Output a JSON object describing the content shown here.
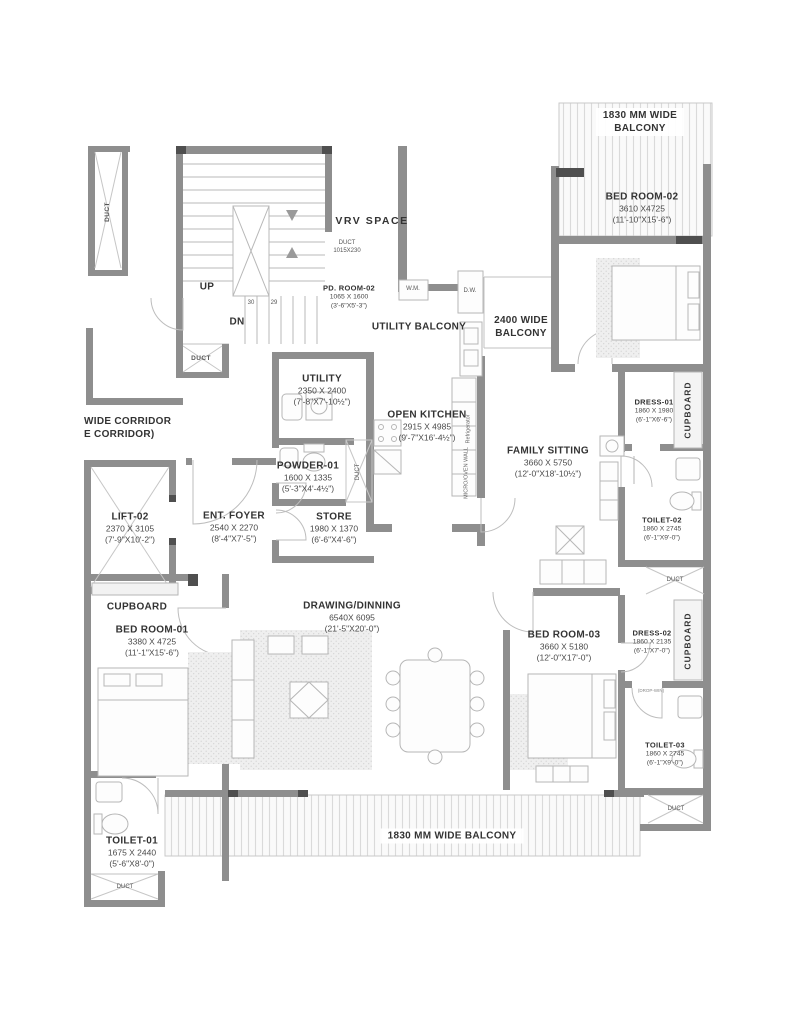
{
  "palette": {
    "wall": "#8e8e8e",
    "jamb": "#4f4f4f",
    "thin": "#c2c2c2",
    "furn": "#b6b6b6",
    "hatch": "#d8d8d8",
    "text": "#3a3a3a"
  },
  "areas": {
    "balcony_top": {
      "line1": "1830 MM  WIDE",
      "line2": "BALCONY"
    },
    "balcony_bottom": {
      "line1": "1830 MM WIDE BALCONY"
    },
    "balcony_2400": {
      "line1": "2400 WIDE",
      "line2": "BALCONY"
    },
    "utility_balcony": {
      "line1": "UTILITY BALCONY"
    },
    "vrv": {
      "line1": "VRV  SPACE"
    },
    "corridor": {
      "line1": "WIDE CORRIDOR",
      "line2": "E CORRIDOR)"
    }
  },
  "rooms": {
    "bedroom02": {
      "name": "BED ROOM-02",
      "mm": "3610 X4725",
      "ft": "(11'-10\"X15'-6\")"
    },
    "dress01": {
      "name": "DRESS-01",
      "mm": "1860 X 1980",
      "ft": "(6'-1\"X6'-6\")"
    },
    "toilet02": {
      "name": "TOILET-02",
      "mm": "1860 X 2745",
      "ft": "(6'-1\"X9'-0\")"
    },
    "dress02": {
      "name": "DRESS-02",
      "mm": "1860 X 2135",
      "ft": "(6'-1\"X7'-0\")"
    },
    "toilet03": {
      "name": "TOILET-03",
      "mm": "1860 X 2745",
      "ft": "(6'-1\"X9'-0\")"
    },
    "bedroom03": {
      "name": "BED ROOM-03",
      "mm": "3660 X 5180",
      "ft": "(12'-0\"X17'-0\")"
    },
    "family_sitting": {
      "name": "FAMILY SITTING",
      "mm": "3660 X 5750",
      "ft": "(12'-0\"X18'-10½\")"
    },
    "open_kitchen": {
      "name": "OPEN KITCHEN",
      "mm": "2915 X 4985",
      "ft": "(9'-7\"X16'-4½\")"
    },
    "utility": {
      "name": "UTILITY",
      "mm": "2350 X 2400",
      "ft": "(7'-8\"X7'-10½\")"
    },
    "powder01": {
      "name": "POWDER-01",
      "mm": "1600 X 1335",
      "ft": "(5'-3\"X4'-4½\")"
    },
    "store": {
      "name": "STORE",
      "mm": "1980 X 1370",
      "ft": "(6'-6\"X4'-6\")"
    },
    "pd_room02": {
      "name": "PD. ROOM-02",
      "mm": "1065 X 1600",
      "ft": "(3'-6\"X5'-3\")"
    },
    "lift02": {
      "name": "LIFT-02",
      "mm": "2370  X 3105",
      "ft": "(7'-9\"X10'-2\")"
    },
    "ent_foyer": {
      "name": "ENT. FOYER",
      "mm": "2540 X 2270",
      "ft": "(8'-4\"X7'-5\")"
    },
    "bedroom01": {
      "name": "BED ROOM-01",
      "mm": "3380  X 4725",
      "ft": "(11'-1\"X15'-6\")"
    },
    "drawing_dinning": {
      "name": "DRAWING/DINNING",
      "mm": "6540X 6095",
      "ft": "(21'-5\"X20'-0\")"
    },
    "toilet01": {
      "name": "TOILET-01",
      "mm": "1675 X 2440",
      "ft": "(5'-6\"X8'-0\")"
    }
  },
  "labels": {
    "duct": "DUCT",
    "duct_dim": "1015X230",
    "cupboard": "CUPBOARD",
    "wm": "W.M.",
    "dw": "D.W.",
    "up": "UP",
    "dn": "DN",
    "steps_left": "30",
    "steps_right": "29",
    "refrigerator": "Refrigerator",
    "microoven": "MICRO/OVEN WALL",
    "drop": "(DROP-WIN)"
  }
}
